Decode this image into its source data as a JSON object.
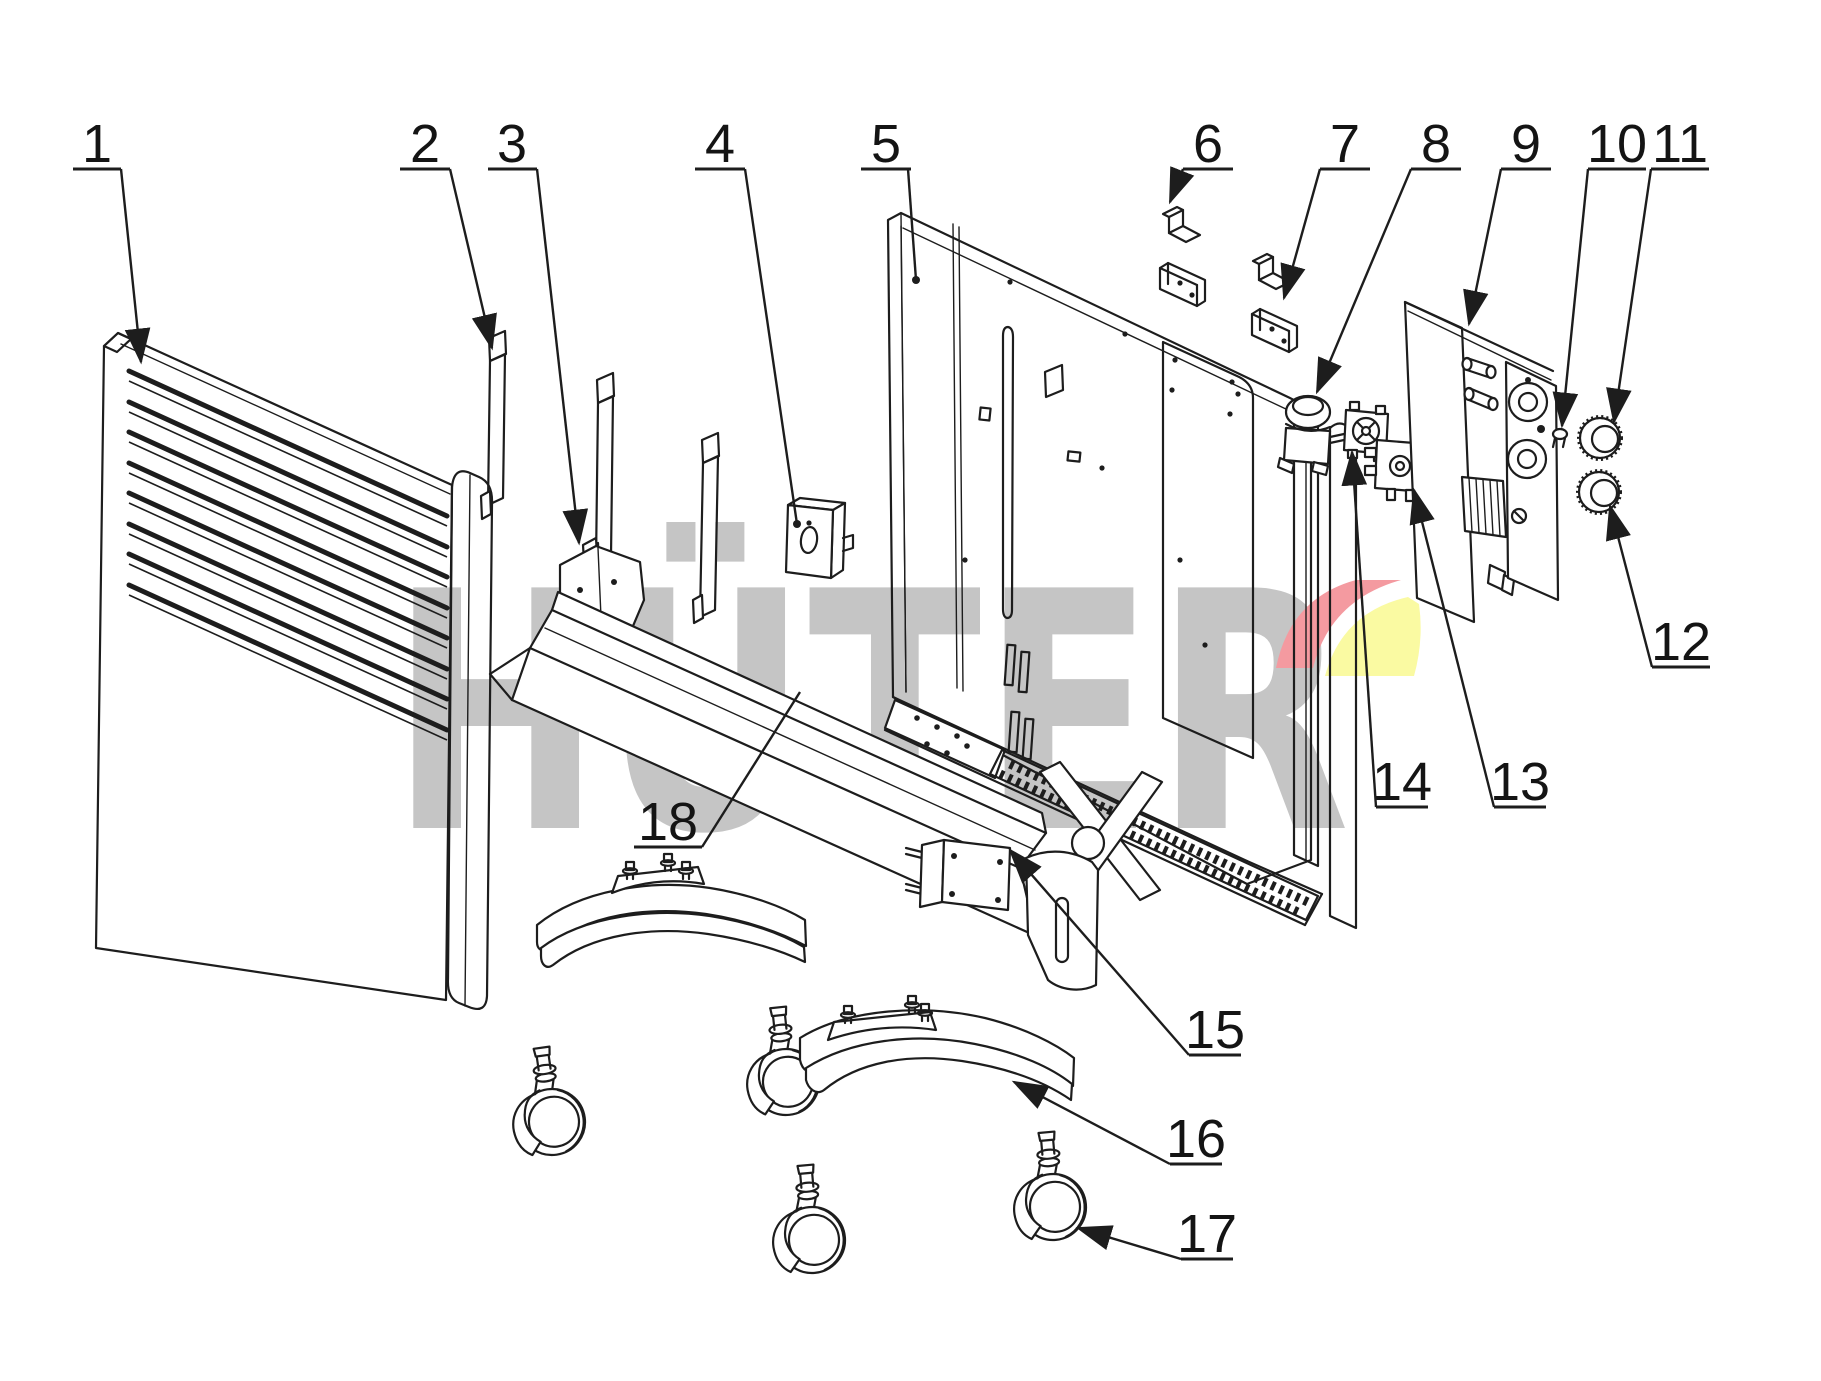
{
  "diagram": {
    "kind": "exploded-parts-diagram",
    "subject": "electric convector heater",
    "background": "#ffffff",
    "line_color": "#1d1d1d",
    "watermark": {
      "text": "HÜTER",
      "text_color": "#c5c5c5",
      "swoosh_red": "#f49aa0",
      "swoosh_yellow": "#fafaa2"
    },
    "callouts": [
      {
        "number": "1",
        "target": "front-panel"
      },
      {
        "number": "2",
        "target": "mounting-strip"
      },
      {
        "number": "3",
        "target": "side-bracket"
      },
      {
        "number": "4",
        "target": "switch-box"
      },
      {
        "number": "5",
        "target": "back-panel"
      },
      {
        "number": "6",
        "target": "wall-bracket-upper"
      },
      {
        "number": "7",
        "target": "wall-bracket-lower"
      },
      {
        "number": "8",
        "target": "motor-unit"
      },
      {
        "number": "9",
        "target": "control-bracket"
      },
      {
        "number": "10",
        "target": "indicator-button"
      },
      {
        "number": "11",
        "target": "knob-upper"
      },
      {
        "number": "12",
        "target": "knob-lower"
      },
      {
        "number": "13",
        "target": "thermostat"
      },
      {
        "number": "14",
        "target": "regulator-valve"
      },
      {
        "number": "15",
        "target": "foot-bracket"
      },
      {
        "number": "16",
        "target": "foot"
      },
      {
        "number": "17",
        "target": "caster"
      },
      {
        "number": "18",
        "target": "heating-element"
      }
    ]
  }
}
